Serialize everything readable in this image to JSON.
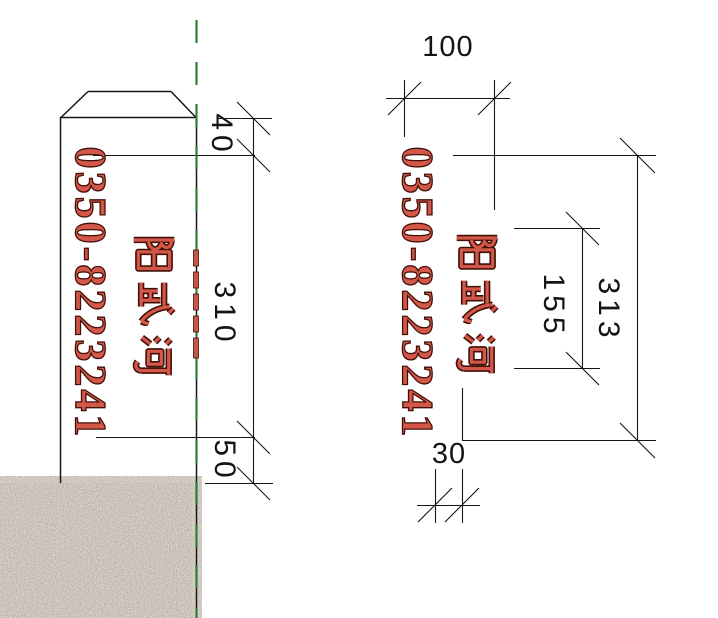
{
  "drawing": {
    "type": "milestone-post-detail",
    "texts": {
      "phone": "0350-8223241",
      "river_name": "阳武河",
      "river_name_chars": [
        "阳",
        "武",
        "河"
      ]
    },
    "dims": {
      "d40": "40",
      "d310": "310",
      "d50": "50",
      "d100": "100",
      "d155": "155",
      "d313": "313",
      "d30": "30"
    },
    "views": {
      "elevation_left": {
        "description": "post elevation with beveled cap, buried in ground hatch",
        "vertical_dimensions": [
          "40",
          "310",
          "50"
        ]
      },
      "side_right": {
        "description": "side face layout",
        "horizontal_dimensions": [
          "100",
          "30"
        ],
        "vertical_dimensions": [
          "155",
          "313"
        ]
      }
    },
    "colors": {
      "text_red": "#d4584a",
      "text_outline": "#431008",
      "centerline_green": "#2f7d31",
      "line_black": "#161616",
      "ground_base": "#cfc5b4"
    }
  }
}
